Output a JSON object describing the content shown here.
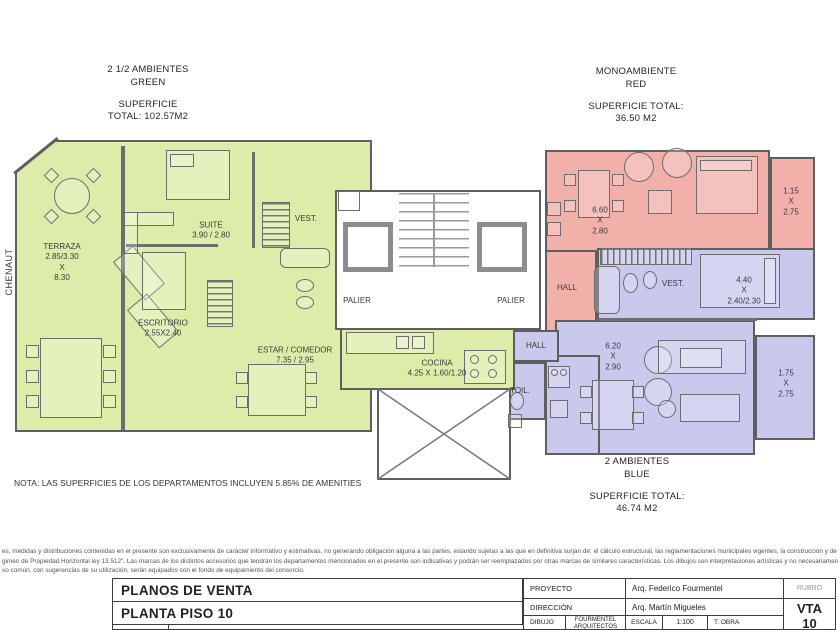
{
  "sheet": {
    "street": "CHENAUT",
    "note": "NOTA: LAS SUPERFICIES DE LOS DEPARTAMENTOS INCLUYEN 5.85% DE AMENITIES"
  },
  "units": {
    "green": {
      "name": [
        "2 1/2 AMBIENTES",
        "GREEN"
      ],
      "area": [
        "SUPERFICIE",
        "TOTAL: 102.57M2"
      ]
    },
    "red": {
      "name": [
        "MONOAMBIENTE",
        "RED"
      ],
      "area": [
        "SUPERFICIE TOTAL:",
        "36.50 M2"
      ]
    },
    "blue": {
      "name": [
        "2 AMBIENTES",
        "BLUE"
      ],
      "area": [
        "SUPERFICIE TOTAL:",
        "46.74 M2"
      ]
    }
  },
  "rooms": {
    "terraza": [
      "TERRAZA",
      "2.85/3.30",
      "X",
      "8.30"
    ],
    "suite": [
      "SUITE",
      "3.90 / 2.80"
    ],
    "vest_green": [
      "VEST."
    ],
    "escritorio": [
      "ESCRITORIO",
      "2.55X2.40"
    ],
    "estar": [
      "ESTAR / COMEDOR",
      "7.35 / 2.95"
    ],
    "cocina": [
      "COCINA",
      "4.25 X 1.60/1.20"
    ],
    "palier_left": [
      "PALIER"
    ],
    "palier_right": [
      "PALIER"
    ],
    "hall_red": [
      "HALL"
    ],
    "red_living": [
      "6.60",
      "X",
      "2.80"
    ],
    "red_balcony": [
      "1.15",
      "X",
      "2.75"
    ],
    "vest_blue": [
      "VEST."
    ],
    "blue_bedroom": [
      "4.40",
      "X",
      "2.40/2.30"
    ],
    "blue_living": [
      "6.20",
      "X",
      "2.90"
    ],
    "blue_balcony": [
      "1.75",
      "X",
      "2.75"
    ],
    "hall_blue": [
      "HALL"
    ],
    "toil": [
      "TOIL."
    ]
  },
  "disclaimer": [
    "es, medidas y distribuciones contenidas en el presente son exclusivamente de carácter informativo y estimativas, no generando obligación alguna a las partes, estando sujetas a las que en definitiva surjan de: el cálculo estructural, las reglamentaciones municipales vigentes, la construcción y de los planos de \"me",
    "gimen de Propiedad Horizontal ley 13.512\". Las marcas de los distintos accesorios que tendrán los departamentos mencionados en el presente son indicativas y podrán ser reemplazados por otras marcas de similares características. Los dibujos son interpretaciones artísticas y no necesariamente una descripción exact",
    "so común, con sugerencias de su utilización, serán equipados con el fondo de equipamiento del consorcio."
  ],
  "titleblock": {
    "doc_title": "PLANOS DE VENTA",
    "sheet_title": "PLANTA PISO 10",
    "proyecto_label": "PROYECTO",
    "proyecto_value": "Arq. Federico Fourmentel",
    "rubro_label": "RUBRO",
    "direccion_label": "DIRECCIÓN",
    "direccion_value": "Arq. Martín Migueles",
    "dibujo_label": "DIBUJO",
    "dibujo_value_1": "FOURMENTEL",
    "dibujo_value_2": "ARQUITECTOS",
    "escala_label": "ESCALA",
    "escala_value": "1:100",
    "tobra_label": "T. OBRA",
    "sheet_code_1": "VTA",
    "sheet_code_2": "10"
  },
  "colors": {
    "unit_green": "#dcedaa",
    "unit_red": "#f2b0ab",
    "unit_blue": "#c9c9ee",
    "wall": "#5f5f5f"
  }
}
